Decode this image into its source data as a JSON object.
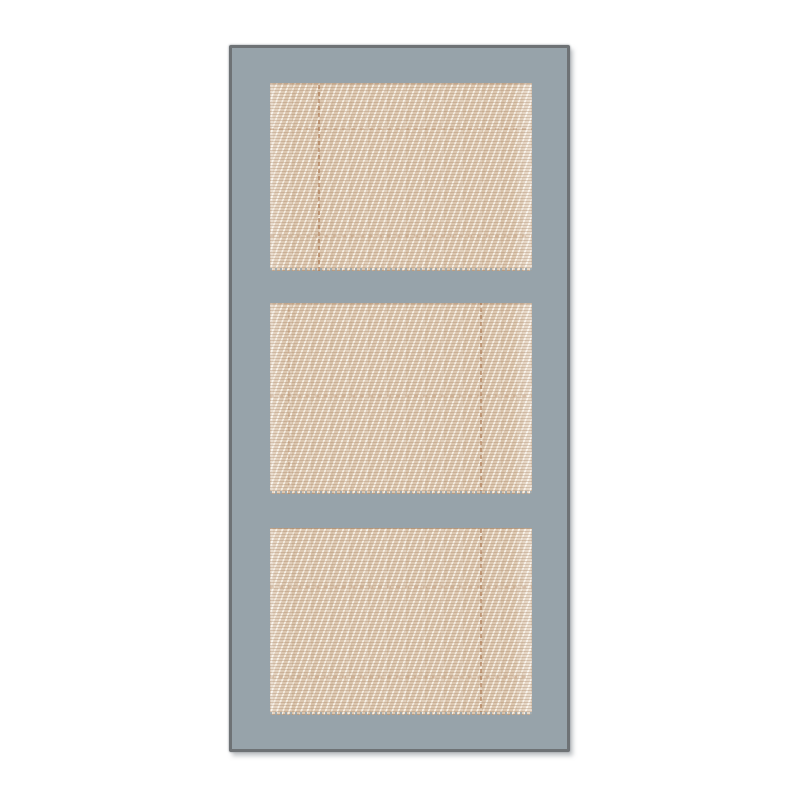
{
  "scene": {
    "object": "three-panel cane-webbing door",
    "description": "Gray-blue framed door with three rectangular woven cane panels, centered on a white background"
  },
  "colors": {
    "background": "#ffffff",
    "frame": "#97a3aa",
    "frame_border": "#6e7275",
    "cane_base": "#dcc7b0",
    "cane_highlight": "#f4eee4",
    "cane_weave_dark": "#b99a77",
    "seam_strong": "rgba(166,111,70,0.55)",
    "seam_faint": "rgba(170,120,80,0.26)"
  },
  "door": {
    "left": 229,
    "top": 45,
    "width": 335,
    "height": 701,
    "border_width": 3
  },
  "panels": [
    {
      "name": "cane-panel-top",
      "left": 38,
      "top": 35,
      "width": 262,
      "height": 188,
      "seams": [
        {
          "type": "v",
          "pos": 48,
          "strength": "strong"
        },
        {
          "type": "h",
          "pos": 45,
          "strength": "faint"
        },
        {
          "type": "h",
          "pos": 152,
          "strength": "faint"
        }
      ]
    },
    {
      "name": "cane-panel-middle",
      "left": 38,
      "top": 255,
      "width": 262,
      "height": 191,
      "seams": [
        {
          "type": "v",
          "pos": 210,
          "strength": "strong"
        },
        {
          "type": "v",
          "pos": 18,
          "strength": "faint"
        },
        {
          "type": "h",
          "pos": 92,
          "strength": "faint"
        }
      ]
    },
    {
      "name": "cane-panel-bottom",
      "left": 38,
      "top": 480,
      "width": 262,
      "height": 187,
      "seams": [
        {
          "type": "v",
          "pos": 210,
          "strength": "strong"
        },
        {
          "type": "h",
          "pos": 58,
          "strength": "faint"
        },
        {
          "type": "h",
          "pos": 148,
          "strength": "faint"
        }
      ]
    }
  ]
}
